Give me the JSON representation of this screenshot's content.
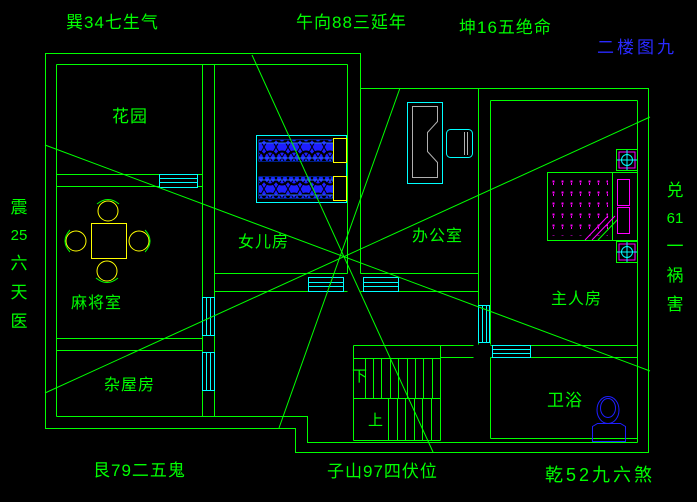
{
  "drawing": {
    "title": "二楼图九",
    "background": "#000000"
  },
  "colors": {
    "wall_green": "#00ff00",
    "window_cyan": "#00ffff",
    "furniture_blue": "#1e1eff",
    "accent_yellow": "#ffff00",
    "accent_magenta": "#ff00ff",
    "title_blue": "#2a2aff",
    "desk_gray": "#b0b0b0"
  },
  "compass_labels": {
    "top_left": "巽34七生气",
    "top_center": "午向88三延年",
    "top_right": "坤16五绝命",
    "bottom_left": "艮79二五鬼",
    "bottom_center": "子山97四伏位",
    "bottom_right": "乾52九六煞",
    "left": {
      "parts": [
        "震",
        "25",
        "六",
        "天",
        "医"
      ]
    },
    "right": {
      "parts": [
        "兑",
        "61",
        "一",
        "祸",
        "害"
      ]
    }
  },
  "rooms": {
    "garden": "花园",
    "daughter_room": "女儿房",
    "office": "办公室",
    "mahjong_room": "麻将室",
    "storage_room": "杂屋房",
    "master_room": "主人房",
    "bathroom": "卫浴"
  },
  "stairs": {
    "down": "下",
    "up": "上"
  }
}
